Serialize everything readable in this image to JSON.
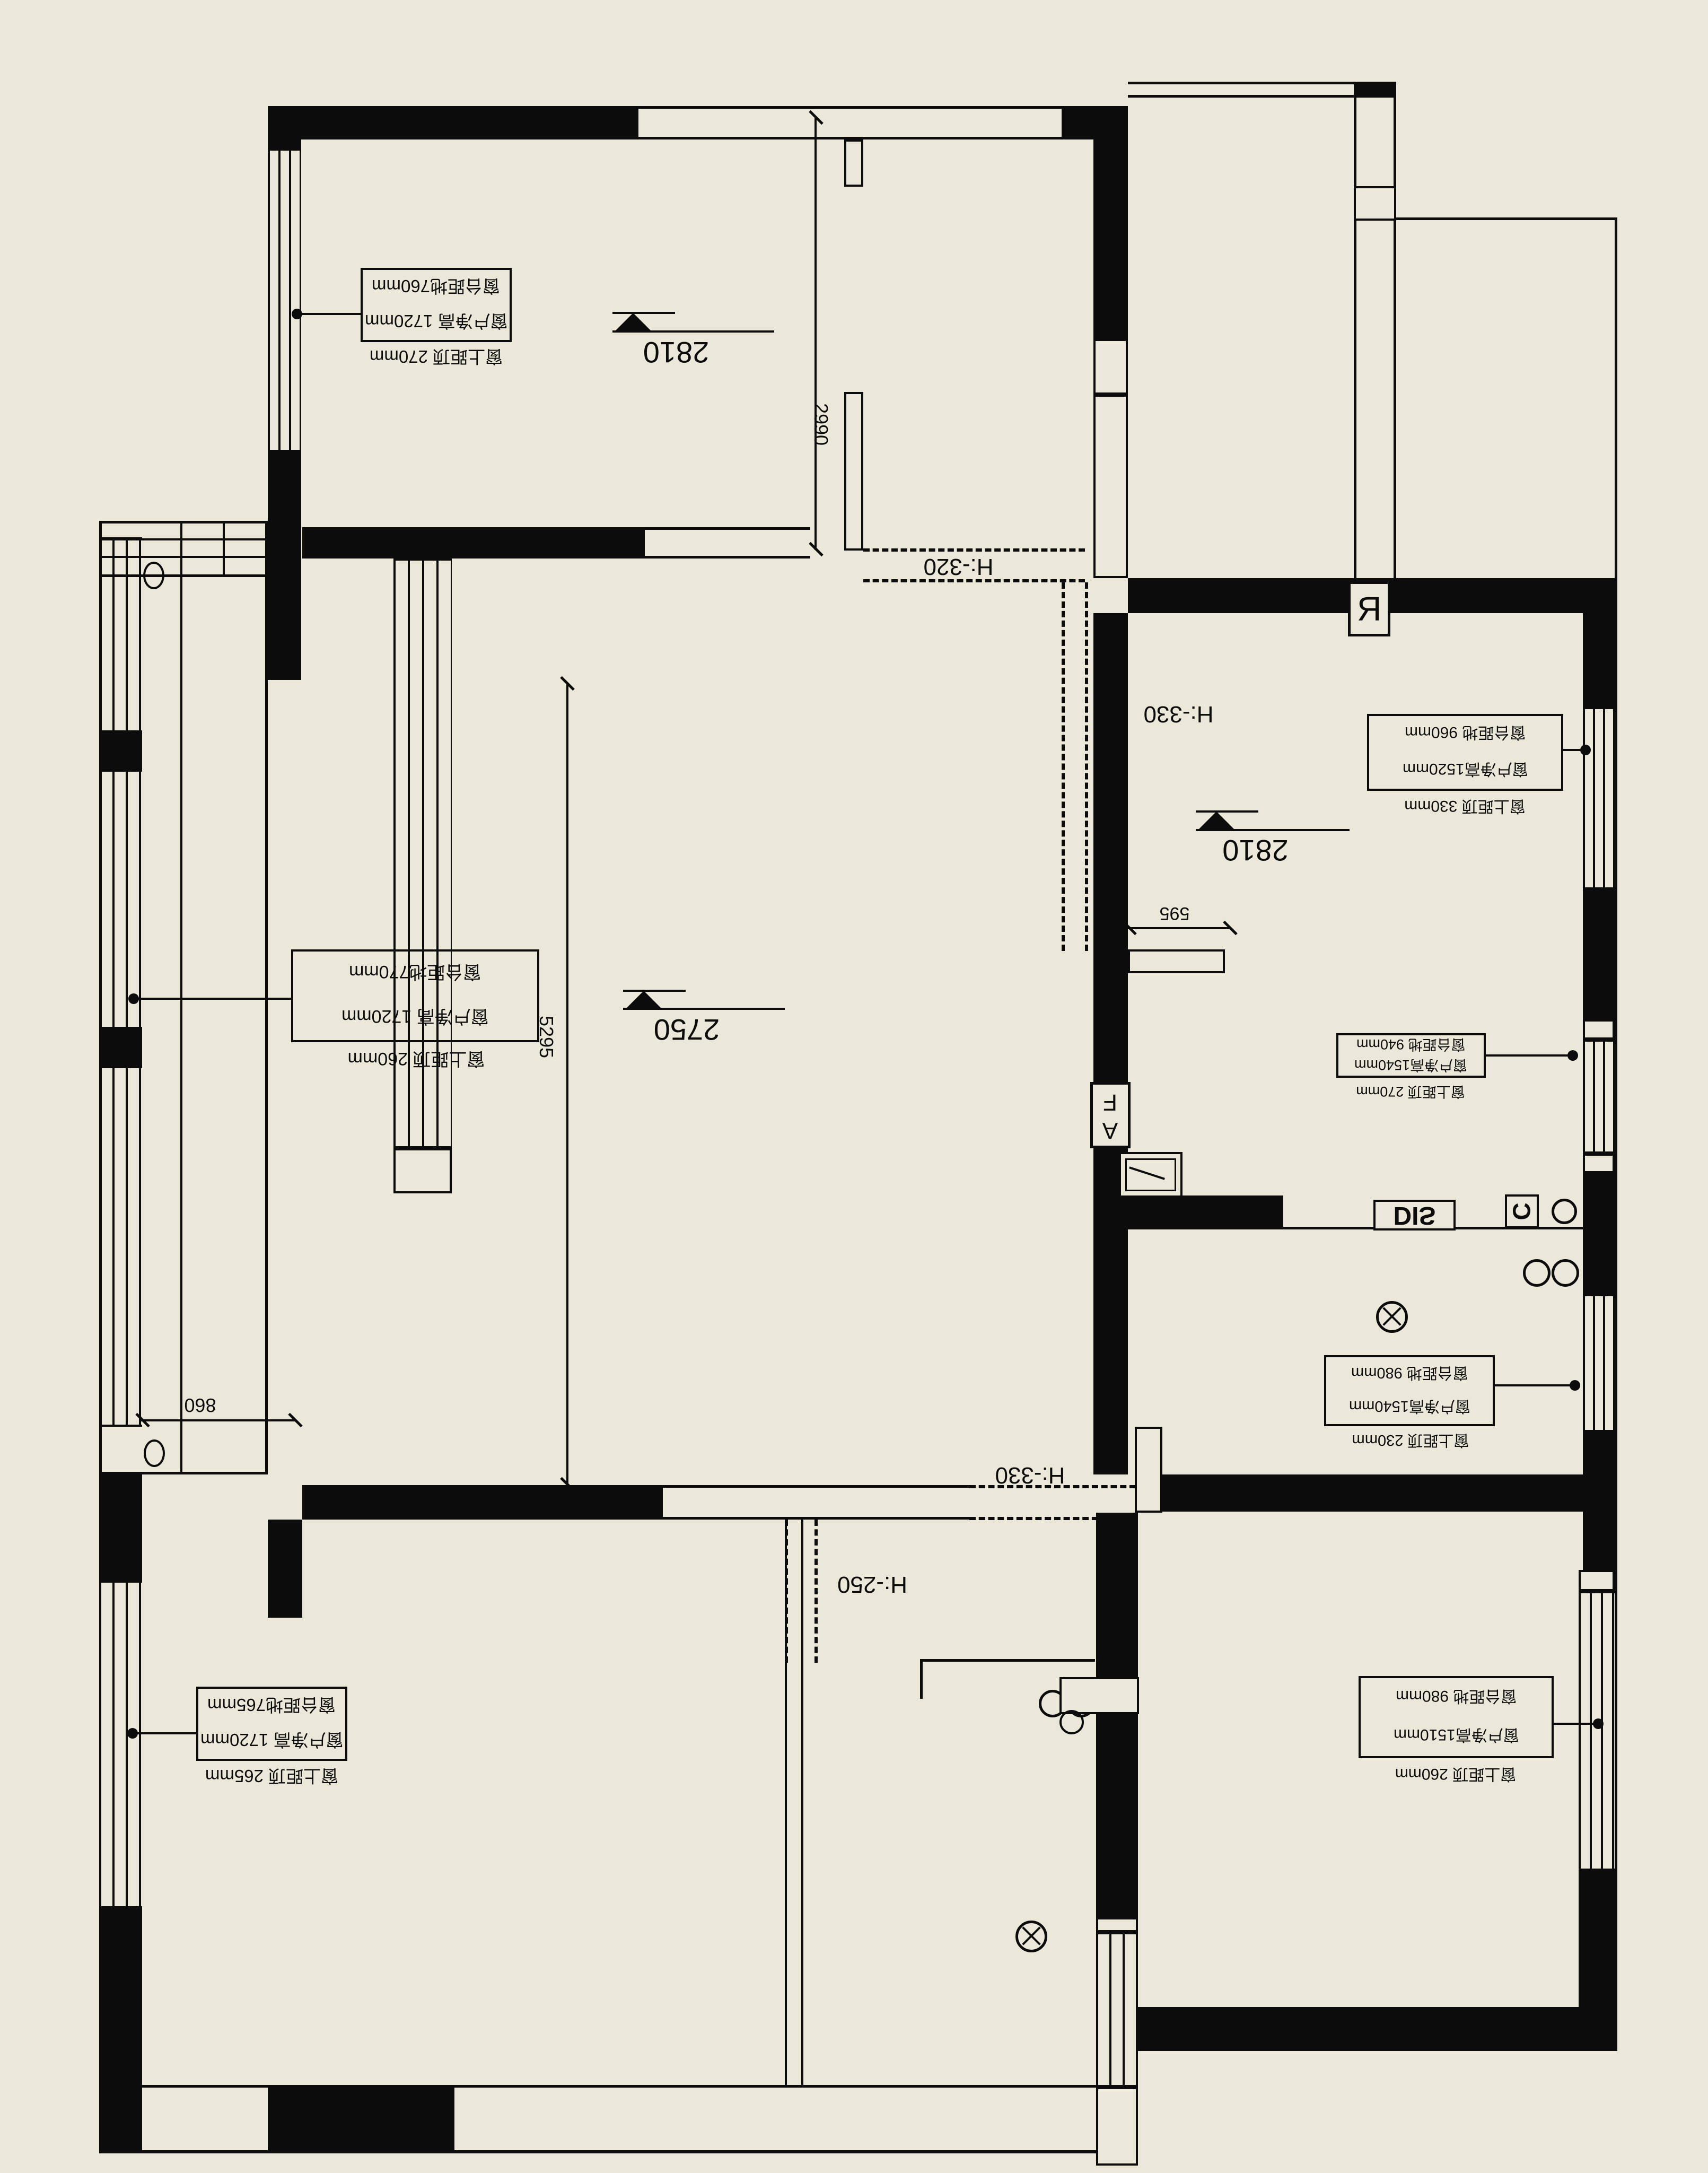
{
  "drawing": {
    "type": "floor-plan",
    "orientation": "rotated-180",
    "background_color": "#ece8d9",
    "ink_color": "#0c0c0c"
  },
  "annotations": [
    {
      "id": "nw-window",
      "rows": [
        "窗台距地760mm",
        "窗户净高 1720mm",
        "窗上距顶 270mm"
      ]
    },
    {
      "id": "west-mid-window",
      "rows": [
        "窗台距地770mm",
        "窗户净高 1720mm",
        "窗上距顶 260mm"
      ]
    },
    {
      "id": "sw-window",
      "rows": [
        "窗台距地765mm",
        "窗户净高 1720mm",
        "窗上距顶 265mm"
      ]
    },
    {
      "id": "kitchen-upper-window",
      "rows": [
        "窗台距地 960mm",
        "窗户净高1520mm",
        "窗上距顶 330mm"
      ]
    },
    {
      "id": "kitchen-lower-window",
      "rows": [
        "窗台距地 940mm",
        "窗户净高1540mm",
        "窗上距顶 270mm"
      ]
    },
    {
      "id": "bath-east-window",
      "rows": [
        "窗台距地 980mm",
        "窗户净高1540mm",
        "窗上距顶 230mm"
      ]
    },
    {
      "id": "se-window",
      "rows": [
        "窗台距地 980mm",
        "窗户净高1510mm",
        "窗上距顶 260mm"
      ]
    }
  ],
  "levels": [
    {
      "id": "nw-room",
      "value": "2810"
    },
    {
      "id": "living-hall",
      "value": "2750"
    },
    {
      "id": "kitchen",
      "value": "2810"
    }
  ],
  "dims": [
    {
      "id": "entry-height",
      "value": "2990"
    },
    {
      "id": "hall-height",
      "value": "5295"
    },
    {
      "id": "kitchen-stub",
      "value": "595"
    },
    {
      "id": "balcony-door",
      "value": "860"
    }
  ],
  "floors": [
    {
      "id": "entry",
      "value": "H:-320"
    },
    {
      "id": "kitchen",
      "value": "H:-330"
    },
    {
      "id": "hall-south",
      "value": "H:-330"
    },
    {
      "id": "corridor",
      "value": "H:-250"
    }
  ],
  "tags": [
    {
      "id": "gas-meter",
      "value": "R"
    },
    {
      "id": "af-marker",
      "value": "AF"
    },
    {
      "id": "dishwasher",
      "value": "DIS"
    },
    {
      "id": "c-marker",
      "value": "C"
    }
  ]
}
